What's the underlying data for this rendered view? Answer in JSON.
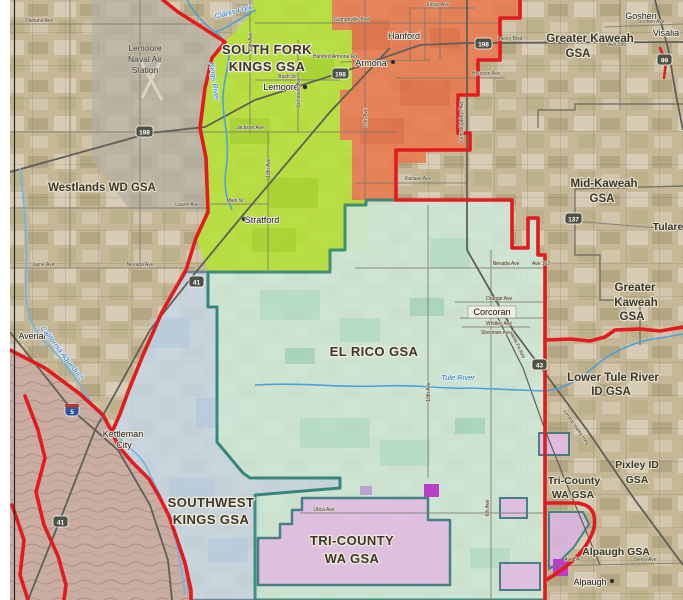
{
  "map": {
    "kind": "GSA boundary map, Tulare Lake subbasin, California",
    "colors": {
      "background_tan": "#c6b897",
      "south_fork_kings_green": "#b5e139",
      "hanford_orange": "#e87a50",
      "el_rico_mint": "#cfe9d9",
      "el_rico_border_teal": "#2f8577",
      "southwest_kings_blue": "#c7d8e6",
      "southwest_kings_border": "#5b7f9e",
      "tri_county_pink": "#e2bce2",
      "pink_border": "#3a7580",
      "boundary_red": "#e11b1e",
      "magenta_patch": "#b83ec9",
      "hills": "#c9ada3",
      "road_gray": "#6e6b5f",
      "river_blue": "#4ea0d8"
    },
    "labels": {
      "gsa": {
        "south_fork_1": "SOUTH FORK",
        "south_fork_2": "KINGS GSA",
        "westlands": "Westlands WD GSA",
        "gk_top_1": "Greater Kaweah",
        "gk_top_2": "GSA",
        "mid_kaweah_1": "Mid-Kaweah",
        "mid_kaweah_2": "GSA",
        "gk_right_1": "Greater",
        "gk_right_2": "Kaweah",
        "gk_right_3": "GSA",
        "tulare": "Tulare",
        "el_rico": "EL RICO GSA",
        "ltr_1": "Lower Tule River",
        "ltr_2": "ID GSA",
        "sw_1": "SOUTHWEST",
        "sw_2": "KINGS GSA",
        "tc_big_1": "TRI-COUNTY",
        "tc_big_2": "WA GSA",
        "tc_small_1": "Tri-County",
        "tc_small_2": "WA GSA",
        "pixley_1": "Pixley ID",
        "pixley_2": "GSA",
        "alpaugh_gsa": "Alpaugh GSA",
        "naval_1": "Lemoore",
        "naval_2": "Naval Air",
        "naval_3": "Station"
      },
      "towns": {
        "lemoore": "Lemoore",
        "armona": "Armona",
        "hanford": "Hanford",
        "goshen": "Goshen",
        "visalia": "Visalia",
        "stratford": "Stratford",
        "corcoran": "Corcoran",
        "kettleman_1": "Kettleman",
        "kettleman_2": "City",
        "alpaugh": "Alpaugh",
        "avenal": "Avenal"
      },
      "roads": {
        "oakland": "Oakland Ave",
        "jackson": "Jackson Ave",
        "laurel": "Laurel Ave",
        "nevada_w": "Nevada Ave",
        "jayne": "Jayne Ave",
        "grangeville": "Grangeville Blvd",
        "fargo": "Fargo Ave",
        "hanford_armona": "Hanford Armona Rd",
        "bush": "Bush St",
        "main_st": "Main St",
        "lacey": "Lacey Blvd",
        "houston": "Houston Ave",
        "kansas": "Kansas Ave",
        "goshen_ave": "Goshen Ave",
        "ave296": "Ave 296",
        "nevada_e": "Nevada Ave",
        "ave192": "Ave 192",
        "orange": "Orange Ave",
        "whitley": "Whitley Ave",
        "sherman": "Sherman Ave",
        "utica": "Utica Ave",
        "sierra": "Sierra Ave",
        "ave54": "Ave 54",
        "ave19": "19th Ave",
        "lemoore_ave": "Lemoore Ave",
        "ave18": "18th Ave",
        "ave14": "14th Ave",
        "ave10": "10th Ave",
        "ave6": "6th Ave",
        "cvh_n": "Central Valley Hwy",
        "cvh_s": "Central Valley Hwy",
        "santa_fe": "Santa Fe Ave"
      },
      "rivers": {
        "clarks_fork": "Clarks Fork",
        "kings": "Kings River",
        "aqueduct": "California Aqueduct",
        "tule": "Tule River"
      },
      "shields": {
        "s198a": "198",
        "s198b": "198",
        "s198c": "198",
        "s41a": "41",
        "s41b": "41",
        "s5": "5",
        "s43": "43",
        "s137": "137",
        "s99": "99"
      }
    }
  }
}
